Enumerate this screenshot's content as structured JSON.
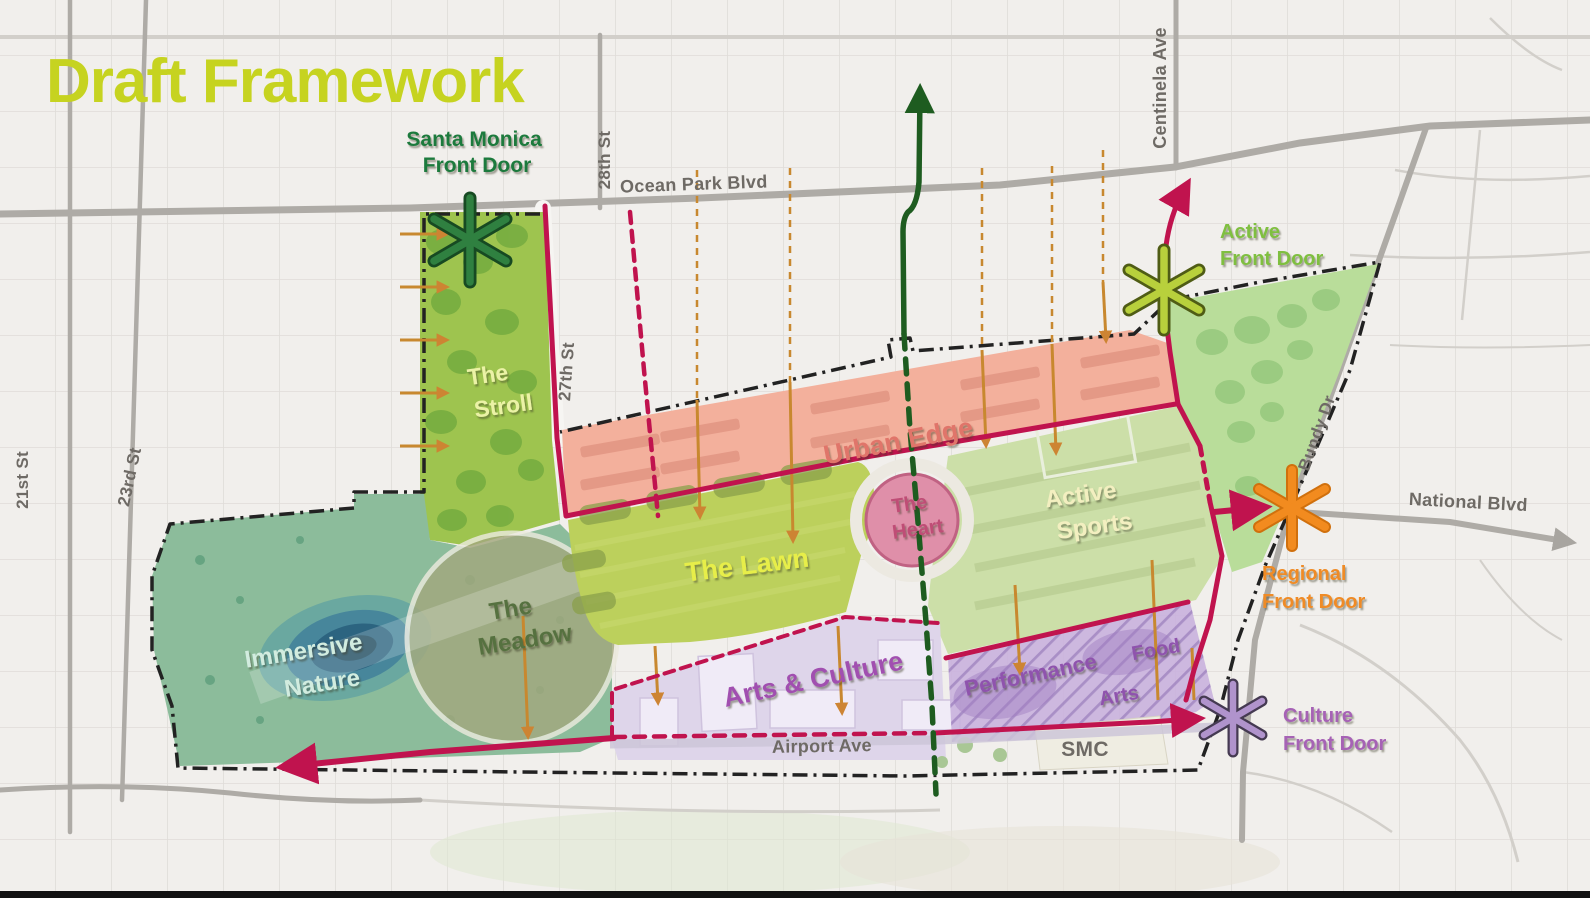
{
  "title": "Draft Framework",
  "colors": {
    "title": "#c6d320",
    "primary_route": "#c0134e",
    "transit_route": "#1e5c20",
    "connection_guide": "#c8882f",
    "site_boundary": "#222222"
  },
  "streets": {
    "ocean_park": "Ocean Park Blvd",
    "st_28": "28th St",
    "st_27": "27th St",
    "st_23": "23rd St",
    "st_21": "21st St",
    "centinela": "Centinela Ave",
    "bundy": "Bundy Dr",
    "national": "National Blvd",
    "airport": "Airport Ave",
    "smc": "SMC"
  },
  "zones": {
    "stroll": {
      "line1": "The",
      "line2": "Stroll",
      "color": "#ebf2a6"
    },
    "urban_edge": {
      "label": "Urban Edge",
      "color": "#e0756a"
    },
    "heart": {
      "line1": "The",
      "line2": "Heart",
      "color": "#bf4e76"
    },
    "active_sports": {
      "line1": "Active",
      "line2": "Sports",
      "color": "#f3efc0"
    },
    "lawn": {
      "label": "The Lawn",
      "color": "#e7ee48"
    },
    "meadow": {
      "line1": "The",
      "line2": "Meadow",
      "color": "#57713f"
    },
    "immersive": {
      "line1": "Immersive",
      "line2": "Nature",
      "color": "#d2ecdf"
    },
    "arts_culture": {
      "label": "Arts & Culture",
      "color": "#a14fb0"
    },
    "performance": {
      "label": "Performance",
      "color": "#8f52ad"
    },
    "food": {
      "label": "Food",
      "color": "#8f52ad"
    },
    "arts": {
      "label": "Arts",
      "color": "#8f52ad"
    }
  },
  "front_doors": {
    "santa_monica": {
      "line1": "Santa Monica",
      "line2": "Front Door",
      "color": "#1f7a3c"
    },
    "active": {
      "line1": "Active",
      "line2": "Front Door",
      "color": "#7fbf3f"
    },
    "regional": {
      "line1": "Regional",
      "line2": "Front Door",
      "color": "#ef8b25"
    },
    "culture": {
      "line1": "Culture",
      "line2": "Front Door",
      "color": "#a662b5"
    }
  }
}
